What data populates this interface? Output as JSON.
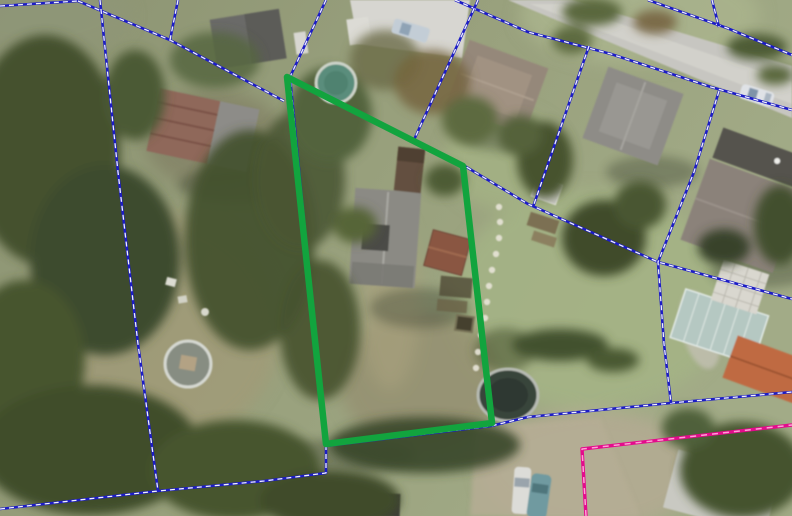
{
  "map": {
    "kind": "aerial-photo-with-cadastral-overlay",
    "width": 792,
    "height": 516
  },
  "colors": {
    "parcel_boundary_blue": "#1c1cc6",
    "boundary_dash_white": "#f0f0ff",
    "highlight_green": "#12a43e",
    "boundary_magenta": "#e40a8c",
    "magenta_dash": "#ff9fd6"
  },
  "overlay": {
    "highlighted_parcel": {
      "name": "highlighted-parcel-outline",
      "stroke_width": 6.5,
      "closed": true,
      "points": [
        [
          287,
          77
        ],
        [
          463,
          166
        ],
        [
          492,
          423
        ],
        [
          326,
          444
        ]
      ]
    },
    "parcel_boundaries": {
      "stroke_width": 2.6,
      "dash_width": 1.3,
      "dash_pattern": "5 4",
      "lines": [
        {
          "points": [
            [
              0,
              6
            ],
            [
              78,
              1
            ]
          ]
        },
        {
          "points": [
            [
              78,
              1
            ],
            [
              170,
              40
            ],
            [
              284,
              101
            ]
          ]
        },
        {
          "points": [
            [
              178,
              0
            ],
            [
              170,
              40
            ]
          ]
        },
        {
          "points": [
            [
              326,
              0
            ],
            [
              290,
              77
            ],
            [
              326,
              445
            ]
          ]
        },
        {
          "points": [
            [
              290,
              78
            ],
            [
              463,
              165
            ],
            [
              528,
              204
            ],
            [
              658,
              262
            ],
            [
              792,
              299
            ]
          ]
        },
        {
          "points": [
            [
              0,
              509
            ],
            [
              158,
              491
            ],
            [
              264,
              481
            ],
            [
              326,
              473
            ],
            [
              326,
              446
            ],
            [
              491,
              426
            ],
            [
              528,
              417
            ],
            [
              671,
              403
            ],
            [
              792,
              392
            ]
          ]
        },
        {
          "points": [
            [
              100,
              0
            ],
            [
              118,
              172
            ],
            [
              138,
              344
            ],
            [
              158,
              491
            ]
          ]
        },
        {
          "points": [
            [
              455,
              0
            ],
            [
              528,
              32
            ],
            [
              611,
              54
            ],
            [
              711,
              87
            ],
            [
              792,
              110
            ]
          ]
        },
        {
          "points": [
            [
              648,
              0
            ],
            [
              727,
              28
            ],
            [
              792,
              55
            ]
          ]
        },
        {
          "points": [
            [
              712,
              0
            ],
            [
              719,
              27
            ]
          ]
        },
        {
          "points": [
            [
              478,
              0
            ],
            [
              413,
              142
            ]
          ]
        },
        {
          "points": [
            [
              589,
              46
            ],
            [
              533,
              207
            ]
          ]
        },
        {
          "points": [
            [
              719,
              91
            ],
            [
              694,
              172
            ],
            [
              658,
              262
            ],
            [
              664,
              344
            ],
            [
              671,
              403
            ]
          ]
        }
      ]
    },
    "boundary_magenta": {
      "name": "magenta-boundary-line",
      "stroke_width": 3.4,
      "dash_width": 1.5,
      "dash_pattern": "6 5",
      "points": [
        [
          586,
          516
        ],
        [
          582,
          449
        ],
        [
          792,
          425
        ]
      ]
    }
  }
}
